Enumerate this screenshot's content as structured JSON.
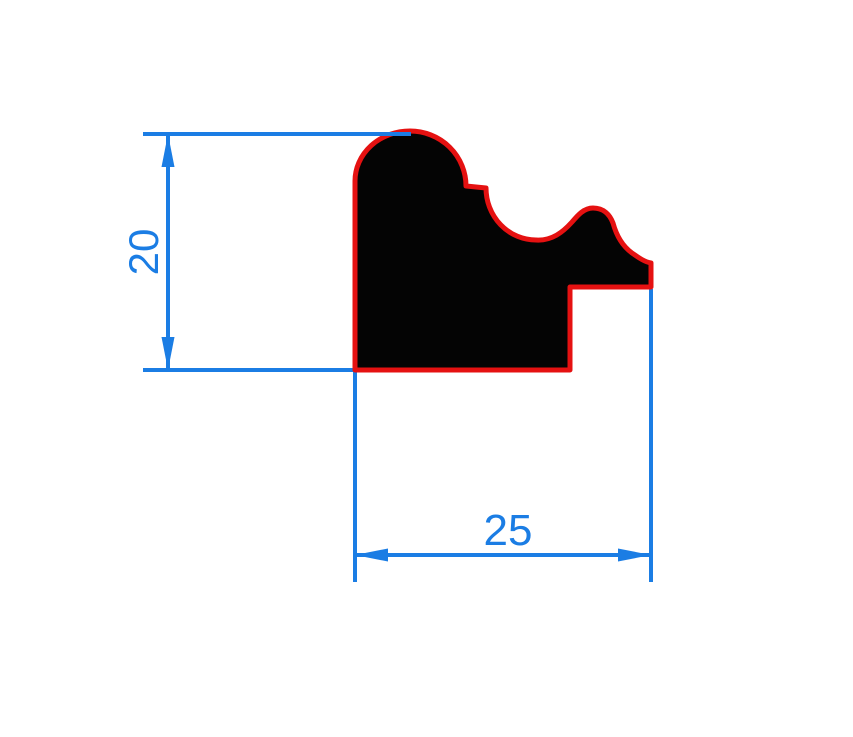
{
  "drawing": {
    "type": "technical-drawing-moulding-profile-cross-section",
    "background": "#ffffff"
  },
  "colors": {
    "dimension_blue": "#1b7de4",
    "outline_red": "#e51111",
    "profile_fill": "#040404"
  },
  "profile": {
    "name": "frame-moulding-profile",
    "path": "M 355 370 L 355 181 A 55 50 0 0 1 410 131 A 56 55 0 0 1 466 186 L 486 188 A 50 52 0 0 0 536 240 C 552 241 563 232 572 222 C 578 215 584 208 593 208 C 604 208 610 215 613 223 C 616 234 621 245 632 253 C 639 258 645 262 651 263 L 651 287 L 570 287 L 570 370 Z",
    "stroke_width": 5
  },
  "dimensions": {
    "height": {
      "label": "20",
      "orientation": "vertical"
    },
    "width": {
      "label": "25",
      "orientation": "horizontal"
    }
  }
}
